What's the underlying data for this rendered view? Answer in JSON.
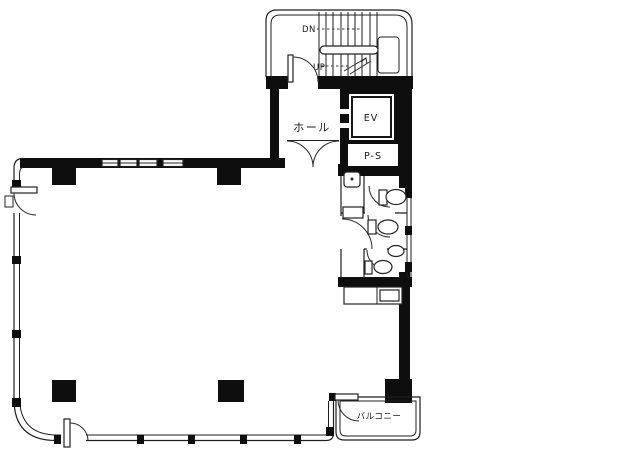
{
  "diagram": {
    "kind": "building-floor-plan",
    "labels": {
      "stairs_down": "DN",
      "stairs_up": "UP",
      "hall": "ホール",
      "elevator": "EV",
      "pipe_shaft": "P-S",
      "balcony": "バルコニー"
    },
    "colors": {
      "paper": "#ffffff",
      "wall_fill": "#0e0e0e",
      "line": "#1f1f1f"
    }
  }
}
